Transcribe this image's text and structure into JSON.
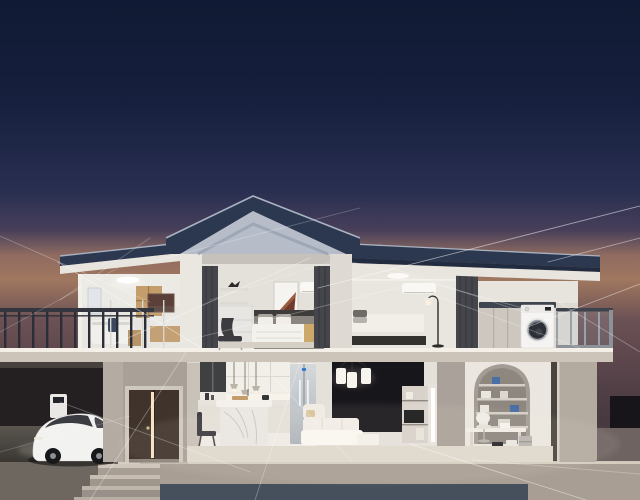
{
  "meta": {
    "image_type": "3d-render-illustration",
    "subject": "dusk cutaway view of a two-story smart home with glowing connectivity lines",
    "width": 640,
    "height": 500
  },
  "scene": {
    "time_of_day": "dusk",
    "rooms": [
      {
        "id": "balcony-bathroom",
        "contents": [
          "balcony railing",
          "bathtub",
          "wood cabinet",
          "ceiling light",
          "daybed"
        ]
      },
      {
        "id": "master-bedroom",
        "contents": [
          "gable roof",
          "curtains",
          "bed",
          "lounge chair",
          "glass dresser",
          "wall art",
          "air-conditioner",
          "shelf with bird figurine"
        ]
      },
      {
        "id": "right-bedroom",
        "contents": [
          "air-conditioner",
          "bed",
          "floor lamp",
          "curtain"
        ]
      },
      {
        "id": "laundry-terrace",
        "contents": [
          "washing machine",
          "counter cabinets",
          "glass railing",
          "soffit light"
        ]
      },
      {
        "id": "garage",
        "contents": [
          "white electric car",
          "wall charger",
          "charging cable"
        ]
      },
      {
        "id": "entry",
        "contents": [
          "dark double door ajar",
          "steps"
        ]
      },
      {
        "id": "kitchen",
        "contents": [
          "upper cabinets",
          "pendant lights",
          "marble island",
          "counter",
          "chair",
          "refrigerator"
        ]
      },
      {
        "id": "living-room",
        "contents": [
          "chandelier",
          "dark accent wall",
          "white sofa",
          "gold side tables",
          "media shelf with tv",
          "led wall strip"
        ]
      },
      {
        "id": "study",
        "contents": [
          "arched shelf alcove",
          "books",
          "desk",
          "white chair",
          "bins",
          "canister"
        ]
      }
    ]
  },
  "colors": {
    "sky_top": "#101a33",
    "sky_upper": "#16203e",
    "sky_mid": "#282e50",
    "sky_violet": "#473f5a",
    "sky_warm": "#8f6b60",
    "sky_horizon": "#a0775f",
    "sky_lower": "#6b5155",
    "sky_low": "#4a3a42",
    "sky_bottom": "#403439",
    "roof": "#2c3850",
    "roof_edge": "#a9b2c1",
    "roof_dark": "#222c40",
    "pediment": "#b6bdc9",
    "pediment_shadow": "#99a1b1",
    "wall_white": "#eae6e0",
    "wall_warm": "#efebe5",
    "wall_dim": "#b4aca2",
    "wall_right": "#b3aaa0",
    "wall_mid": "#aaa29a",
    "slab": "#ccc4b9",
    "slab_top": "#f4f0e8",
    "interior_wall": "#e4e0da",
    "interior_floor": "#dfd8ce",
    "terrace": "#b5aba0",
    "apron": "#a89e93",
    "plinth": "#464f5c",
    "driveway": "#6e6760",
    "right_band": "#6e6361",
    "hedge": "#17141a",
    "garage_dark": "#1b181a",
    "garage_wall": "#242021",
    "garage_floor": "#514c47",
    "door": "#3f332b",
    "door_light": "#ffedc9",
    "frame": "#cfc8bf",
    "curtain": "#45464c",
    "accent": "#17161a",
    "wood": "#c49e6a",
    "wood_warm": "#b98f5e",
    "tan": "#c8a35e",
    "gold": "#d8b878",
    "marble": "#eae7e3",
    "fridge_top": "#d5d9dc",
    "fridge_bottom": "#aeb4ba",
    "logo_blue": "#3b7bd4",
    "washer": "#f5f4f2",
    "washer_door": "#2c2f35",
    "washer_ring": "#9ba1a8",
    "rail_dark": "#2b2e36",
    "glass_post": "#9aa0a8",
    "glass_tint": "#b8c6d0",
    "chair": "#3c3b3f",
    "art": "#9a5a40",
    "towel": "#2e3a52",
    "book": "#4a6fa5",
    "arch": "#a39c94",
    "arch_inner": "#8e8780",
    "car": "#f2f2f0",
    "car_glass": "#2a2d33",
    "wheel": "#17181a",
    "hub": "#8e9094",
    "charger": "#e9e8e4",
    "line": "#ffffff",
    "lamp_dark": "#2a2a2c"
  },
  "network": {
    "lines": [
      [
        0,
        236,
        150,
        302,
        0.28
      ],
      [
        0,
        332,
        118,
        268,
        0.22
      ],
      [
        58,
        262,
        200,
        347,
        0.45
      ],
      [
        96,
        352,
        310,
        258,
        0.38
      ],
      [
        140,
        352,
        420,
        282,
        0.28
      ],
      [
        186,
        352,
        90,
        500,
        0.32
      ],
      [
        60,
        402,
        250,
        472,
        0.32
      ],
      [
        300,
        362,
        255,
        500,
        0.3
      ],
      [
        262,
        364,
        352,
        462,
        0.28
      ],
      [
        210,
        300,
        330,
        262,
        0.22
      ],
      [
        318,
        288,
        640,
        206,
        0.5
      ],
      [
        352,
        262,
        560,
        318,
        0.3
      ],
      [
        420,
        290,
        580,
        348,
        0.28
      ],
      [
        523,
        312,
        392,
        268,
        0.3
      ],
      [
        548,
        262,
        640,
        238,
        0.45
      ],
      [
        520,
        330,
        640,
        284,
        0.42
      ],
      [
        555,
        300,
        640,
        352,
        0.3
      ],
      [
        410,
        444,
        586,
        500,
        0.45
      ],
      [
        472,
        460,
        640,
        474,
        0.28
      ],
      [
        0,
        452,
        130,
        416,
        0.2
      ],
      [
        150,
        262,
        360,
        208,
        0.25
      ],
      [
        150,
        238,
        60,
        300,
        0.25
      ]
    ]
  }
}
